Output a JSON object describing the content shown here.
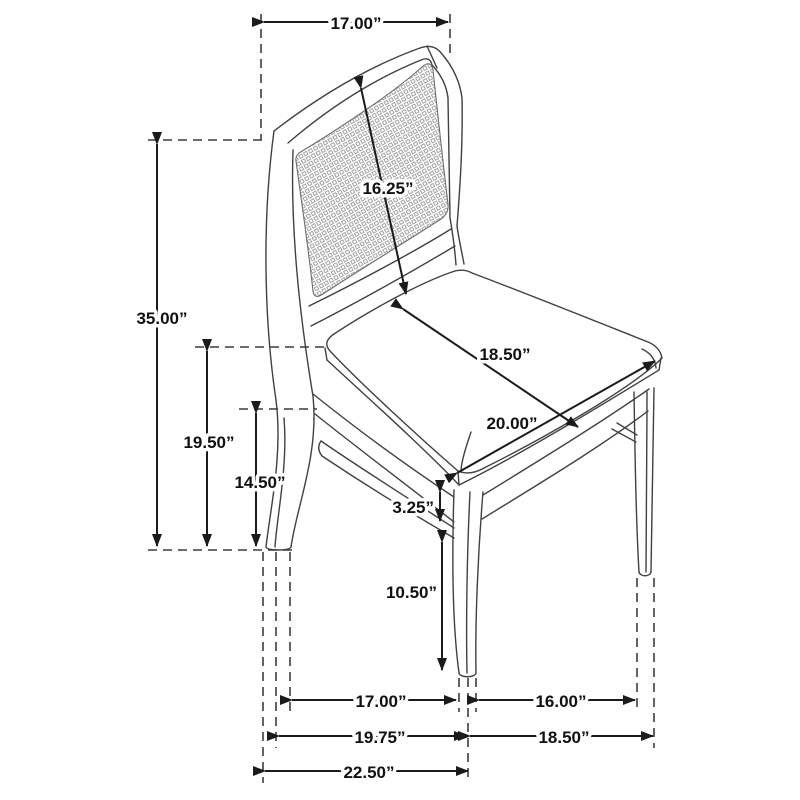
{
  "diagram": {
    "subject": "dining side chair with cane backrest",
    "unit": "inches",
    "colors": {
      "background": "#ffffff",
      "line_art": "#414141",
      "dimension_lines": "#1b1b1b",
      "extension_dashes": "#3d3d3d",
      "label_text": "#111111",
      "cane_weave": "#9d9d9d"
    },
    "dims": {
      "top_width": "17.00”",
      "backrest_panel": "16.25”",
      "overall_height": "35.00”",
      "seat_top_height": "19.50”",
      "seat_rail_height": "14.50”",
      "seat_depth": "18.50”",
      "seat_width": "20.00”",
      "apron_thickness": "3.25”",
      "leg_height": "10.50”",
      "front_leg_span_inner": "17.00”",
      "side_leg_span_inner": "16.00”",
      "front_width_outer": "19.75”",
      "side_depth_outer": "18.50”",
      "overall_depth": "22.50”"
    }
  }
}
